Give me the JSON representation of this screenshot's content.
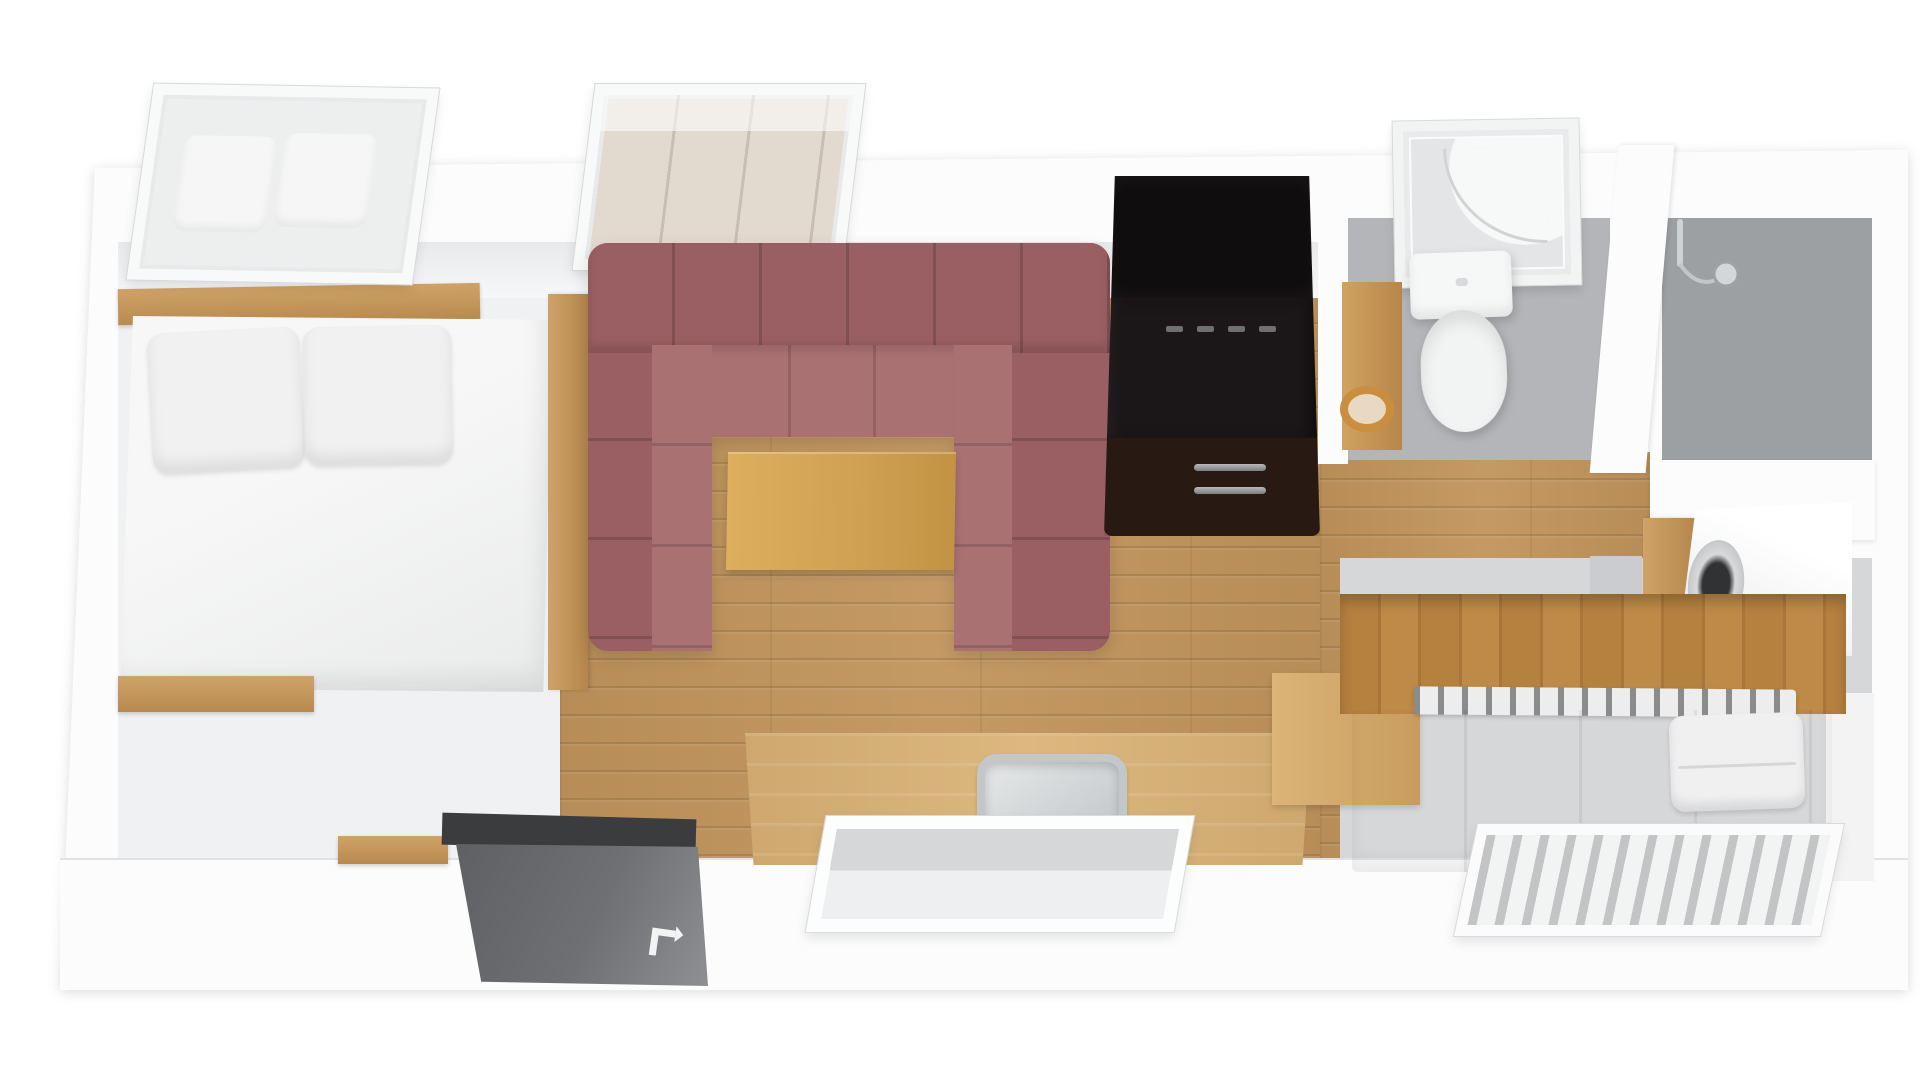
{
  "scene": {
    "kind": "3d-floor-plan-render",
    "rooms": [
      "bedroom",
      "living-room",
      "kitchen",
      "bathroom",
      "shower-room",
      "laundry-nook",
      "second-bedroom",
      "entry"
    ]
  },
  "palette": {
    "wall": "#fcfcfd",
    "wall_face": "#e8e9eb",
    "floor_wood": "#c1945c",
    "counter_wood": "#d9b174",
    "table_wood": "#d0a052",
    "plank_wall": "#b5813f",
    "vanity_wood": "#c6934f",
    "sofa_dark": "#9a5f62",
    "sofa_light": "#aa7173",
    "fridge_top": "#0f0d0e",
    "fridge_body": "#1b1617",
    "fridge_freezer": "#281a12",
    "door_panel": "#6e7073",
    "door_header": "#3a3c3e",
    "bath_floor": "#b3b5b8",
    "shower_floor": "#9da0a3",
    "bed2_floor": "#d6d7d9",
    "linen": "#f3f3f4",
    "chrome": "#c6c9cc",
    "glass": "#edefef",
    "glass_warm": "#e2dacf"
  },
  "objects": {
    "shell": "apartment-outer-walls",
    "bedroom_floor": "bedroom-floor",
    "living_floor": "wood-plank-floor",
    "hall_floor": "hallway-wood-floor",
    "bath_floor": "bathroom-floor",
    "shower_floor": "shower-room-floor",
    "bed2_floor": "second-bedroom-floor",
    "headboard": "headboard-shelf",
    "bed1": "double-bed",
    "pillow": "pillow",
    "bed_rail": "bed-side-rail",
    "bench": "wood-bench",
    "window_bed": "open-tilt-window",
    "window_sofa": "open-tilt-window",
    "sofa": "u-shaped-sectional-sofa",
    "coffee_table": "coffee-table",
    "fridge": "refrigerator",
    "fridge_handle": "freezer-drawer-handle",
    "counter": "kitchen-counter",
    "counter_return": "kitchen-counter-return",
    "sink": "kitchen-sink",
    "faucet": "sink-faucet",
    "window_kitchen": "open-tilt-window",
    "door_header": "door-frame-header",
    "door": "entry-door",
    "door_arrow": "door-swing-arrow",
    "shower": "shower-cabin",
    "toilet": "toilet",
    "vanity": "bathroom-vanity",
    "basin": "round-basin",
    "shower_head": "handheld-shower-head",
    "washer_shelf": "laundry-shelf",
    "washer": "washing-machine",
    "plank_wall": "wood-panel-wall",
    "bed2_rail": "bed-frame-rail",
    "bed2": "single-bed",
    "window_bed2": "open-slatted-window",
    "wall": "wall"
  }
}
